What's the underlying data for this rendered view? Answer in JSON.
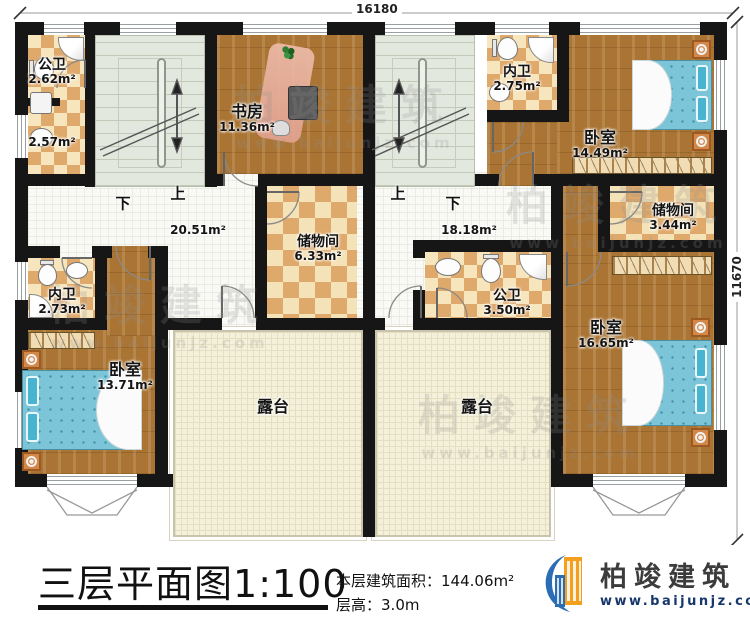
{
  "rooms": {
    "gongwei_tl": {
      "name": "公卫",
      "area": "2.62m²"
    },
    "bath_tl_low": {
      "area": "2.57m²"
    },
    "shufang": {
      "name": "书房",
      "area": "11.36m²"
    },
    "neiwei_tr": {
      "name": "内卫",
      "area": "2.75m²"
    },
    "woshi_tr": {
      "name": "卧室",
      "area": "14.49m²"
    },
    "hall_left": {
      "area": "20.51m²"
    },
    "chuwu_left": {
      "name": "储物间",
      "area": "6.33m²"
    },
    "hall_right": {
      "area": "18.18m²"
    },
    "chuwu_right": {
      "name": "储物间",
      "area": "3.44m²"
    },
    "neiwei_left": {
      "name": "内卫",
      "area": "2.73m²"
    },
    "gongwei_r": {
      "name": "公卫",
      "area": "3.50m²"
    },
    "woshi_bl": {
      "name": "卧室",
      "area": "13.71m²"
    },
    "woshi_br": {
      "name": "卧室",
      "area": "16.65m²"
    },
    "lutai_left": {
      "name": "露台"
    },
    "lutai_right": {
      "name": "露台"
    }
  },
  "stairs": {
    "left": {
      "down": "下",
      "up": "上"
    },
    "right": {
      "up": "上",
      "down": "下"
    }
  },
  "dims": {
    "top": "16180",
    "right": "11670"
  },
  "title": {
    "text": "三层平面图",
    "scale": "1:100",
    "area_label": "本层建筑面积：",
    "area_value": "144.06m²",
    "height_label": "层高：",
    "height_value": "3.0m"
  },
  "logo": {
    "name": "柏竣建筑",
    "url": "www.baijunjz.com"
  },
  "watermark": {
    "name": "柏竣建筑",
    "url": "www.baijunjz.com"
  },
  "colors": {
    "wall": "#161616",
    "wood_floor": "#a97434",
    "tile_light": "#f6e5bd",
    "tile_dark": "#dfa96c",
    "bed_blue": "#7cc5d8",
    "terrace": "#f4f0d9",
    "logo_blue": "#2a6db5",
    "logo_orange": "#f59f1e"
  }
}
